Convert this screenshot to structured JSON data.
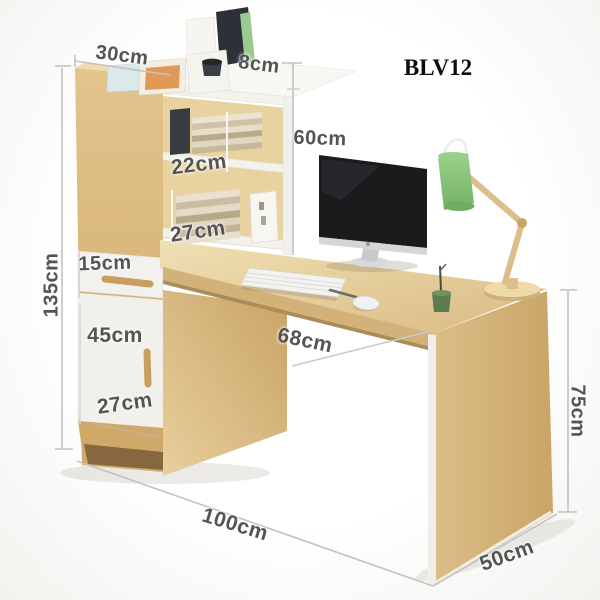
{
  "product": {
    "code": "BLV12"
  },
  "dims": {
    "d30": {
      "label": "30cm"
    },
    "d8": {
      "label": "8cm"
    },
    "d60": {
      "label": "60cm"
    },
    "d22": {
      "label": "22cm"
    },
    "d27_shelf": {
      "label": "27cm"
    },
    "d15": {
      "label": "15cm"
    },
    "d135": {
      "label": "135cm"
    },
    "d45": {
      "label": "45cm"
    },
    "d27_door": {
      "label": "27cm"
    },
    "d68": {
      "label": "68cm"
    },
    "d75": {
      "label": "75cm"
    },
    "d100": {
      "label": "100cm"
    },
    "d50": {
      "label": "50cm"
    }
  },
  "colors": {
    "wood": "#d8b87e",
    "wood_dark": "#c49e63",
    "panel_white": "#f3f1ec",
    "lamp_green": "#86c478",
    "screen_black": "#1b1b1e",
    "dimension_text": "#545454",
    "dimension_line": "#c2c2c2"
  },
  "scene": {
    "objects": [
      "bookshelf-hutch",
      "storage-cabinet",
      "drawer",
      "cabinet-door",
      "desk",
      "desk-side-panel",
      "imac-monitor",
      "keyboard",
      "mouse",
      "desk-lamp",
      "pen-holder",
      "magazine-file-holder",
      "books",
      "leaning-pictures"
    ]
  }
}
